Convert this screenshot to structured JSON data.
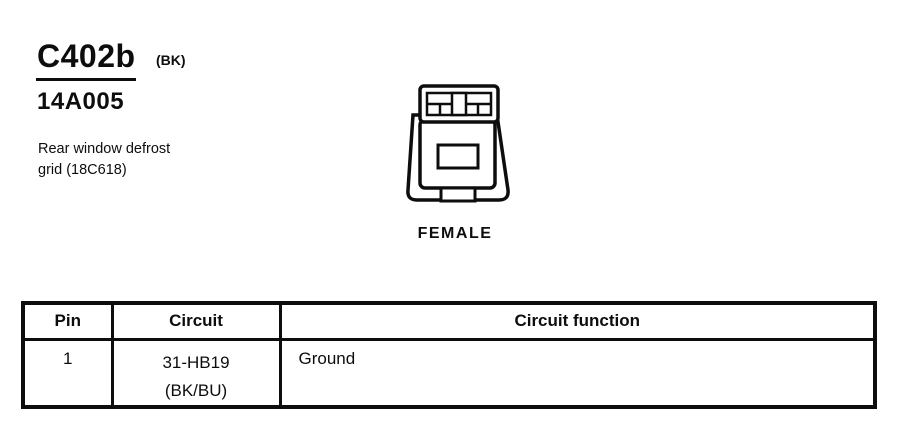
{
  "page": {
    "background": "#ffffff",
    "ink": "#0d0d0d"
  },
  "header": {
    "connector_id": "C402b",
    "connector_color": "(BK)",
    "part_number": "14A005",
    "description_line1": "Rear window defrost",
    "description_line2": "grid (18C618)"
  },
  "connector": {
    "gender_label": "FEMALE"
  },
  "table": {
    "columns": [
      "Pin",
      "Circuit",
      "Circuit function"
    ],
    "rows": [
      {
        "pin": "1",
        "circuit_line1": "31-HB19",
        "circuit_line2": "(BK/BU)",
        "function": "Ground"
      }
    ]
  }
}
